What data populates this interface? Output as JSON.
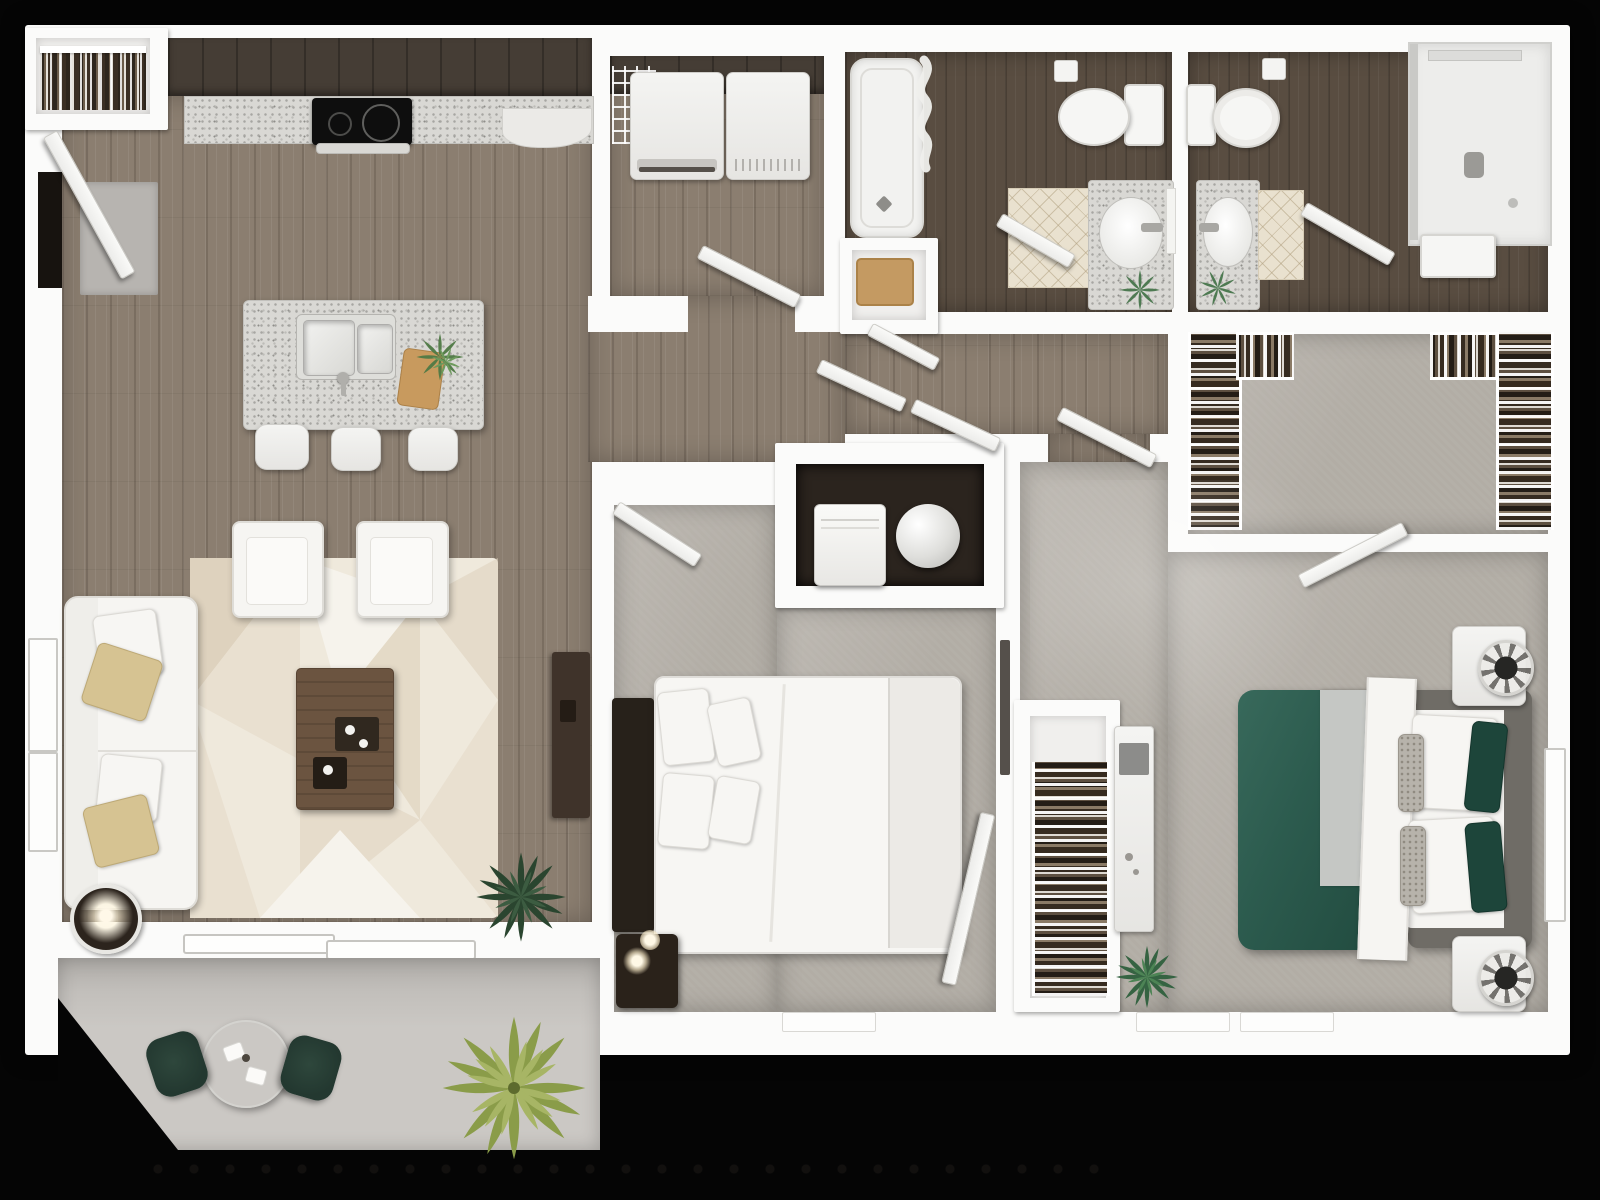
{
  "scene": {
    "type": "3d-floor-plan-top-down-render",
    "description": "Two-bedroom, two-bathroom apartment 3D floor plan viewed from above, no text labels",
    "background": "#050505"
  },
  "palette": {
    "black": "#050505",
    "wall": "#fbfbfa",
    "woodMid": "#8b7e70",
    "woodDark": "#594d41",
    "cabinet": "#453d35",
    "carpet": "#b2ada5",
    "granite": "#d9d8d4",
    "tile": "#e9e1cf",
    "patio": "#cbc8c4",
    "sofaWhite": "#f6f5f2",
    "rugBase": "#efe9dc",
    "rugBeige": "#ded2be",
    "accentTan": "#d6c392",
    "headboardDark": "#27211a",
    "nightstandDark": "#2a221a",
    "greenBed": "#2c5b4e",
    "greenBedDark": "#1d453a",
    "grayFrame": "#6f6c66",
    "grayBlanket": "#c5c7c4",
    "matTan": "#c49a62",
    "palmGreen": "#9fae57",
    "plantGreen": "#2f4c35",
    "chairGreen": "#233830",
    "tvGray": "#8c8c8a",
    "utilityDark": "#2b241e"
  },
  "rooms": [
    {
      "name": "kitchen-living-dining",
      "floor": "wood"
    },
    {
      "name": "entry-closet",
      "floor": "white"
    },
    {
      "name": "laundry-room",
      "floor": "wood"
    },
    {
      "name": "bathroom-1",
      "floor": "dark-wood"
    },
    {
      "name": "bathroom-2",
      "floor": "dark-wood"
    },
    {
      "name": "walk-in-closet",
      "floor": "carpet"
    },
    {
      "name": "hallway",
      "floor": "wood"
    },
    {
      "name": "utility-closet",
      "floor": "dark"
    },
    {
      "name": "bedroom-1",
      "floor": "carpet"
    },
    {
      "name": "bedroom-1-closet",
      "floor": "white"
    },
    {
      "name": "bedroom-2",
      "floor": "carpet"
    },
    {
      "name": "patio",
      "floor": "concrete"
    }
  ],
  "fixtures": [
    "entry-door",
    "kitchen-cabinets",
    "cooktop",
    "kitchen-island",
    "island-sink",
    "bar-stools",
    "sofa",
    "armchairs",
    "area-rug",
    "coffee-table",
    "side-table-lamp",
    "tv-console",
    "washer",
    "dryer",
    "bathtub",
    "shower-curtain",
    "toilet",
    "vanity-sink",
    "walk-in-shower",
    "wire-shelving",
    "water-heater",
    "queen-bed-white",
    "queen-bed-green",
    "nightstands",
    "patio-table",
    "patio-chairs",
    "palm-plant",
    "house-plants",
    "windows",
    "sliding-door"
  ]
}
